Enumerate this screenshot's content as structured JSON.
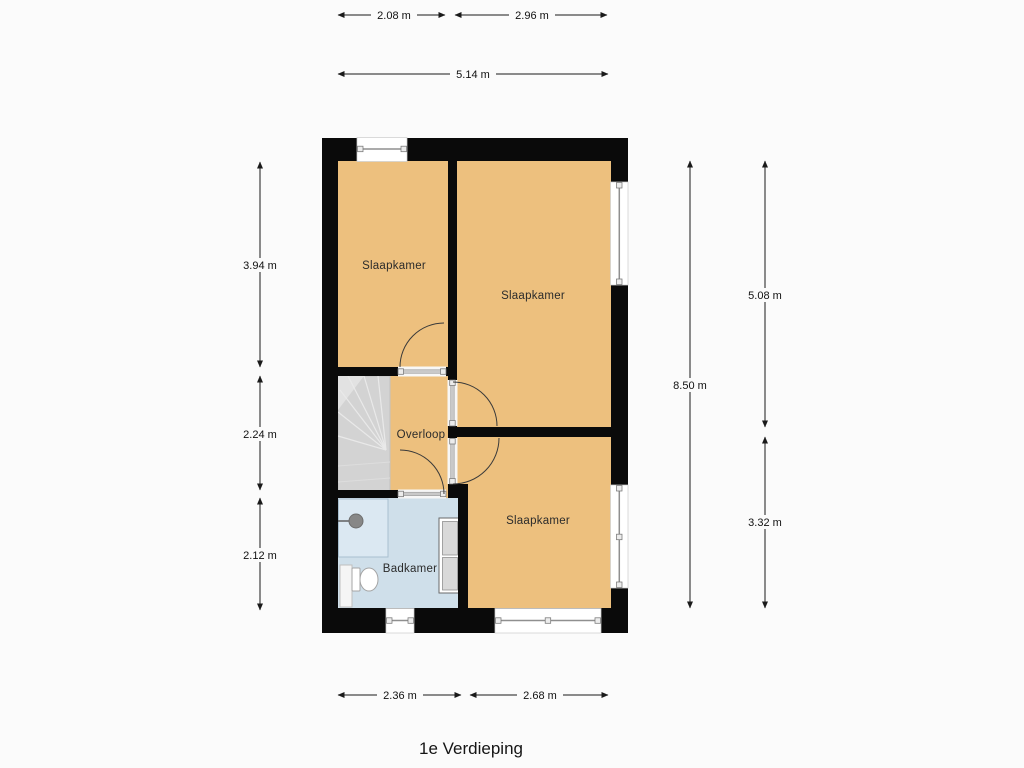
{
  "title": "1e Verdieping",
  "rooms": {
    "bedroom1": {
      "label": "Slaapkamer"
    },
    "bedroom2": {
      "label": "Slaapkamer"
    },
    "bedroom3": {
      "label": "Slaapkamer"
    },
    "landing": {
      "label": "Overloop"
    },
    "bathroom": {
      "label": "Badkamer"
    }
  },
  "dimensions": {
    "top_row": [
      {
        "label": "2.08 m"
      },
      {
        "label": "2.96 m"
      }
    ],
    "top_total": {
      "label": "5.14 m"
    },
    "left": [
      {
        "label": "3.94 m"
      },
      {
        "label": "2.24 m"
      },
      {
        "label": "2.12 m"
      }
    ],
    "right_total": {
      "label": "8.50 m"
    },
    "right": [
      {
        "label": "5.08 m"
      },
      {
        "label": "3.32 m"
      }
    ],
    "bottom": [
      {
        "label": "2.36 m"
      },
      {
        "label": "2.68 m"
      }
    ]
  },
  "colors": {
    "room_fill": "#edc07e",
    "bathroom_fill": "#cfdfea",
    "shower_fill": "#dbe8f2",
    "stairs_fill": "#d3d3d3",
    "wall": "#0a0a0a",
    "dimension_line": "#1a1a1a"
  }
}
